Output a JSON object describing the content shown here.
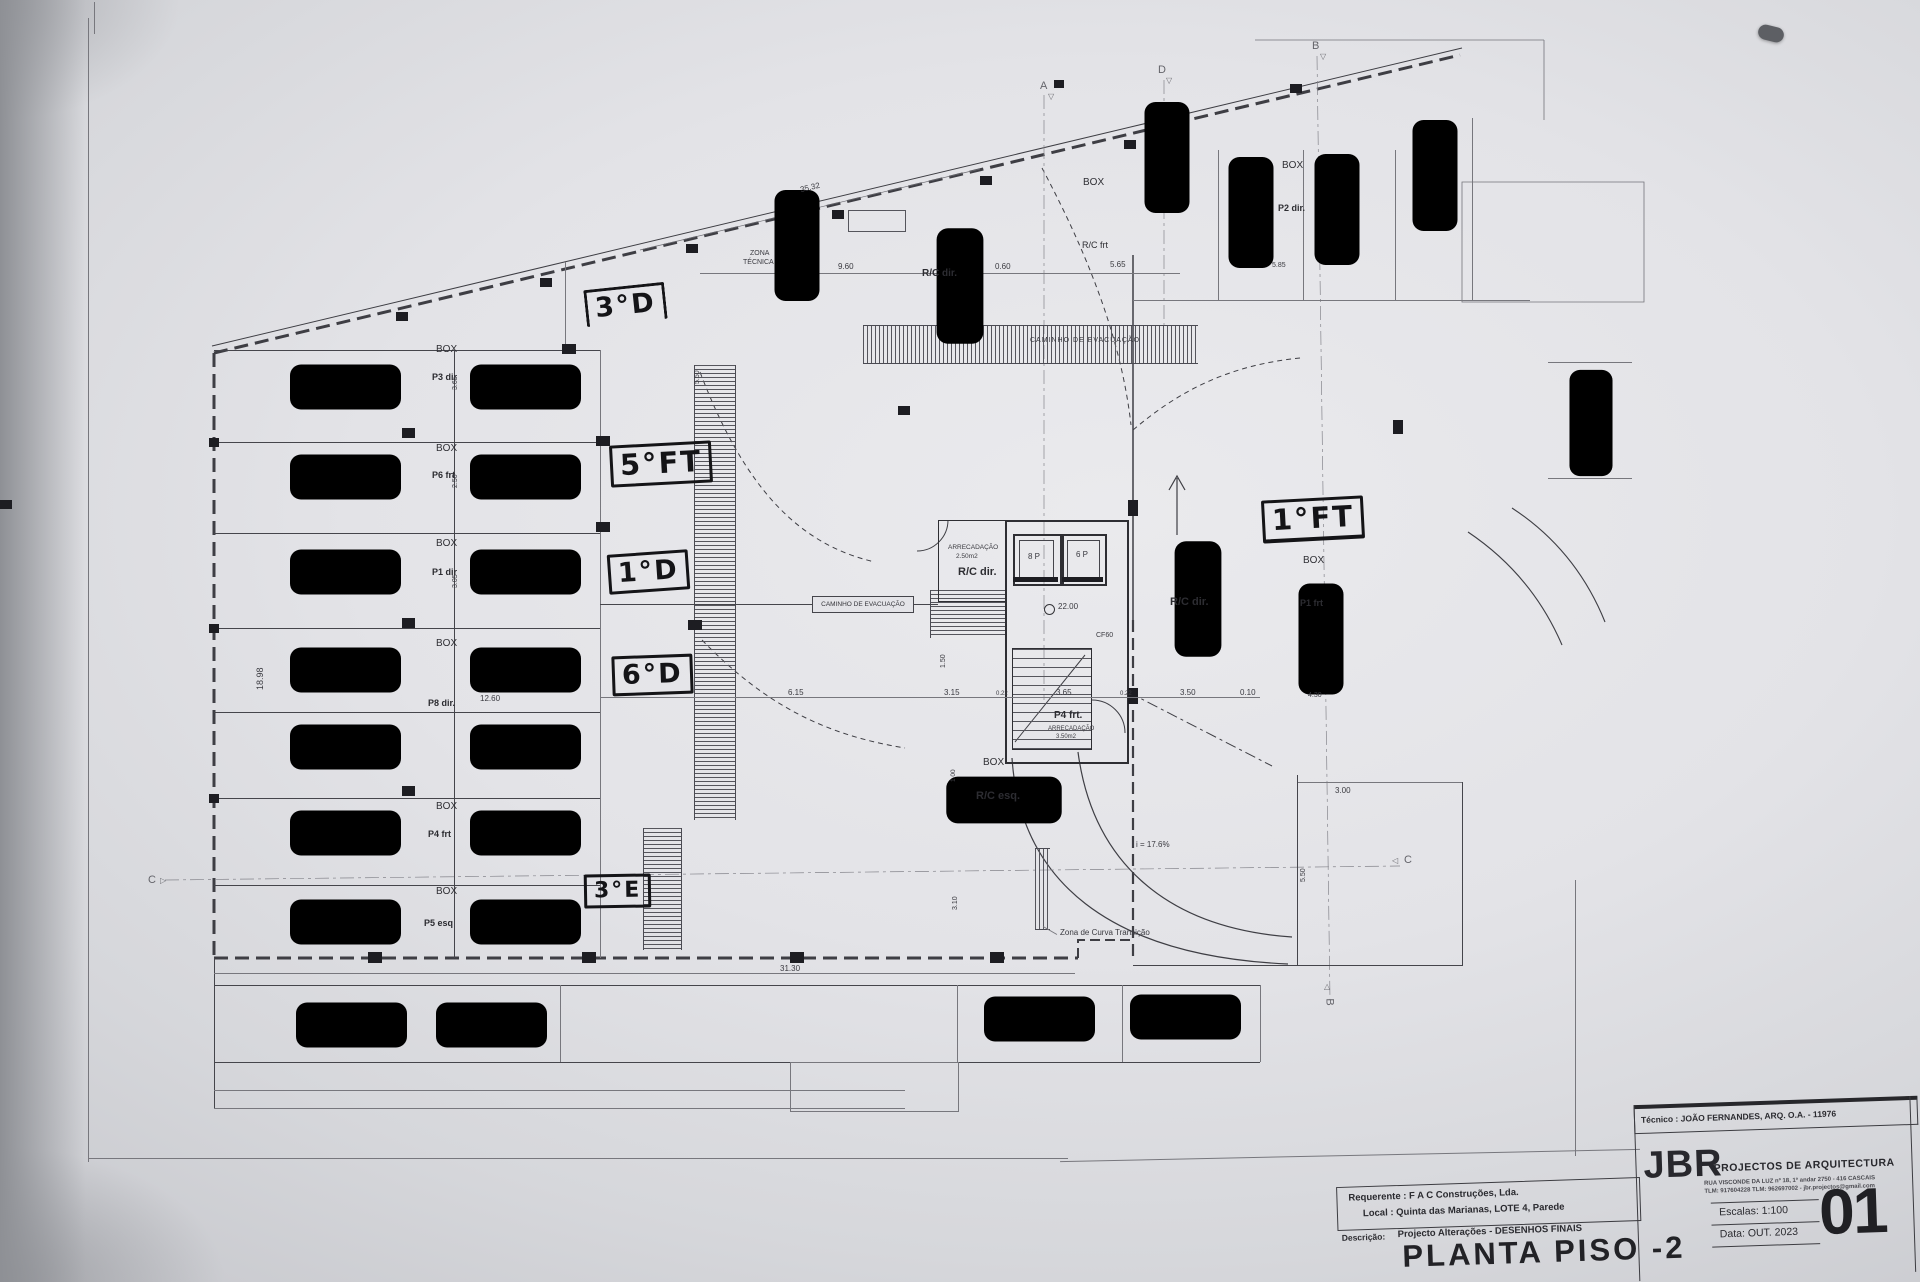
{
  "plan": {
    "box": "BOX",
    "caminho_evacuacao": "CAMINHO DE EVACUAÇÃO",
    "zona_tecnica": [
      "ZONA",
      "TÉCNICA"
    ],
    "stalls": [
      "P3 dir",
      "P6 frt",
      "P1 dir",
      "P8 dir.",
      "P4 frt",
      "P5 esq"
    ],
    "labels": {
      "rc_dir": "R/C dir.",
      "rc_frt": "R/C frt",
      "rc_esq": "R/C esq.",
      "p2_dir": "P2 dir.",
      "p1_frt": "P1 frt",
      "lift_a": "8 P",
      "lift_b": "6 P",
      "level": "22.00",
      "cf60": "CF60",
      "p4_frt": "P4 frt.",
      "arrecadacao": "ARRECADAÇÃO",
      "arrec_area_a": "2.50m2",
      "arrec_area_b": "3.50m2",
      "slope": "i = 17.6%",
      "zona_curva": "Zona de Curva Transição"
    },
    "dims": {
      "d35_32": "35.32",
      "d9_60": "9.60",
      "d0_60": "0.60",
      "d5_65": "5.65",
      "d5_85": "5.85",
      "d18_98": "18.98",
      "d12_60": "12.60",
      "d6_15": "6.15",
      "d3_15": "3.15",
      "d3_65": "3.65",
      "d3_50": "3.50",
      "d0_10": "0.10",
      "d0_22": "0.22",
      "d1_50": "1.50",
      "d1_00": "1.00",
      "d3_10": "3.10",
      "d5_50": "5.50",
      "d3_00": "3.00",
      "d31_30": "31.30",
      "d4_30": "4.30",
      "d2_50": "2.50",
      "d3_05": "3.05"
    },
    "sections": {
      "a": "A",
      "b": "B",
      "c": "C",
      "d": "D"
    }
  },
  "annotations": [
    "3°D",
    "5°FT",
    "1°D",
    "6°D",
    "3°E",
    "1°FT"
  ],
  "title_block": {
    "tecnico": "Técnico : JOÃO FERNANDES, ARQ.   O.A. - 11976",
    "firm_abbr": "JBR",
    "firm_name": "PROJECTOS DE ARQUITECTURA",
    "firm_addr1": "RUA VISCONDE DA LUZ nº 18, 1º andar  2750 - 416  CASCAIS",
    "firm_addr2": "TLM: 917604228  TLM: 962697002 - jbr.projectos@gmail.com",
    "requerente": "Requerente : F A C  Construções, Lda.",
    "local": "Local : Quinta das Marianas, LOTE 4, Parede",
    "descricao_label": "Descrição:",
    "descricao": "Projecto Alterações - DESENHOS FINAIS",
    "escala_label": "Escalas:",
    "escala": "1:100",
    "data_label": "Data:",
    "data": "OUT. 2023",
    "drawing_title": "PLANTA PISO -2",
    "sheet_number": "01"
  }
}
